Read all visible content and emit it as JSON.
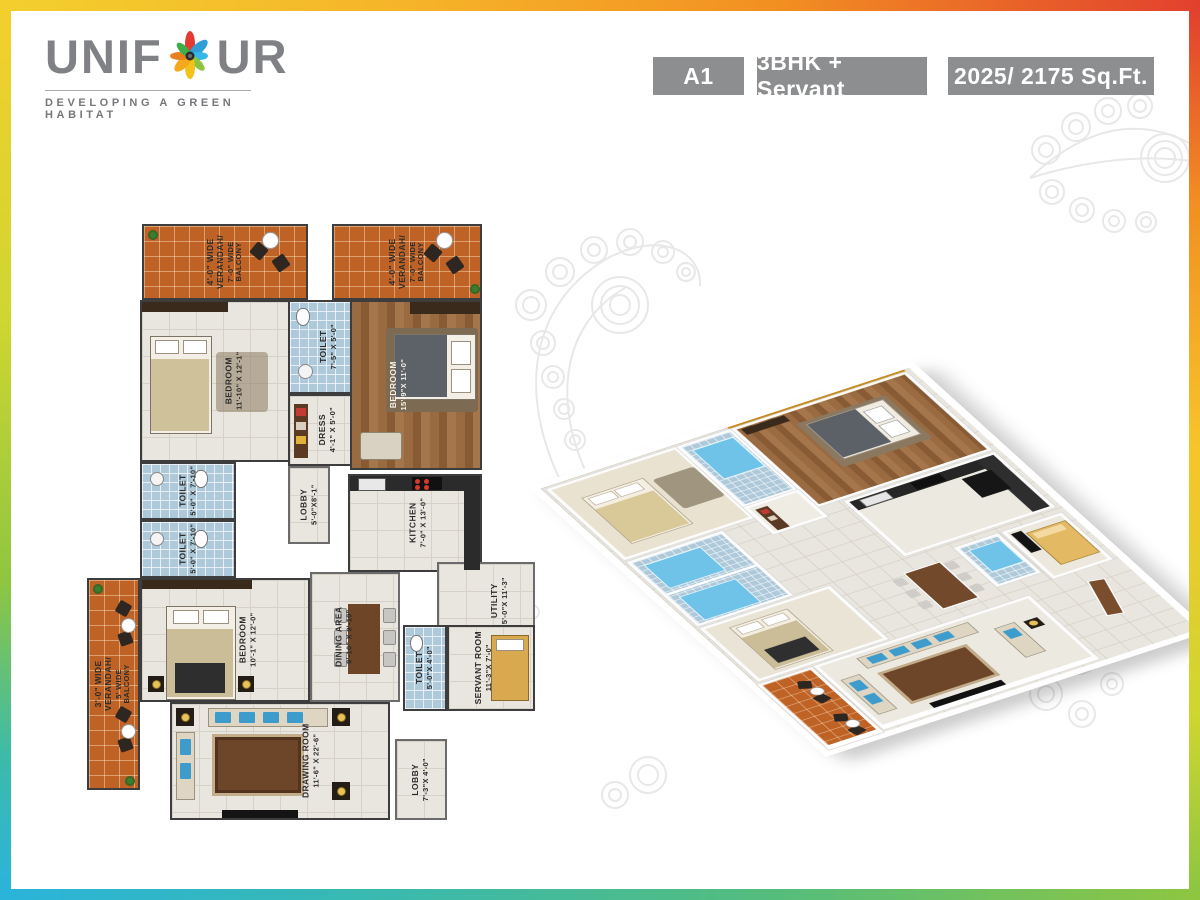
{
  "logo": {
    "brand_pre": "UNIF",
    "brand_post": "UR",
    "tagline": "DEVELOPING A GREEN HABITAT",
    "text_color": "#808184",
    "flower_colors": [
      "#e23b33",
      "#2f9fd8",
      "#35b8e8",
      "#3fae49",
      "#f2c218",
      "#f5a81c",
      "#8bc53f",
      "#e8801f"
    ]
  },
  "header": {
    "badge_bg": "#8d8e90",
    "badges": [
      {
        "label": "A1"
      },
      {
        "label": "3BHK + Servant"
      },
      {
        "label": "2025/ 2175 Sq.Ft."
      }
    ]
  },
  "palette": {
    "verandah_floor": "#bf6226",
    "interior_tile": "#e9e6df",
    "toilet_tile": "#adc9da",
    "wood_floor": "#9a6a41",
    "accent_wall": "#c5891f",
    "sofa_cushion": "#3e9ccc",
    "mandala": "#e8e8e8"
  },
  "plan2d": {
    "rooms": [
      {
        "name": "4'-0\" WIDE VERANDAH/",
        "dims": "7'-0\" WIDE BALCONY"
      },
      {
        "name": "4'-0\" WIDE VERANDAH/",
        "dims": "7'-0\" WIDE BALCONY"
      },
      {
        "name": "BEDROOM",
        "dims": "11'-10\" X 12'-1\""
      },
      {
        "name": "TOILET",
        "dims": "7'-5\" X 5'-0\""
      },
      {
        "name": "DRESS",
        "dims": "4'-1\" X 5'-0\""
      },
      {
        "name": "BEDROOM",
        "dims": "15'-9\"X 11'-0\""
      },
      {
        "name": "TOILET",
        "dims": "5'-0\" X 7'-10\""
      },
      {
        "name": "TOILET",
        "dims": "5'-0\" X 7'-10\""
      },
      {
        "name": "LOBBY",
        "dims": "5'-0\"X8'-1\""
      },
      {
        "name": "KITCHEN",
        "dims": "7'-0\" X 13'-0\""
      },
      {
        "name": "UTILITY",
        "dims": "5'-0\"X 11'-3\""
      },
      {
        "name": "BEDROOM",
        "dims": "10'-1\" X 12'-0\""
      },
      {
        "name": "DINING AREA",
        "dims": "9'-10\" X 9'-10\""
      },
      {
        "name": "TOILET",
        "dims": "5'-0\"X 4'-0\""
      },
      {
        "name": "SERVANT ROOM",
        "dims": "11'-3\"X 7'-0\""
      },
      {
        "name": "LOBBY",
        "dims": "7'-3\"X 4'-0\""
      },
      {
        "name": "DRAWING ROOM",
        "dims": "11'-6\" X 22'-6\""
      },
      {
        "name": "3'-0\" WIDE VERANDAH/",
        "dims": "5' WIDE BALCONY"
      }
    ]
  }
}
